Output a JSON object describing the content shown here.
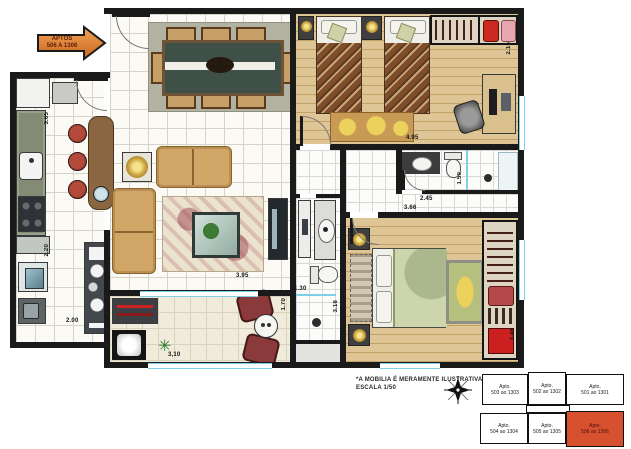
{
  "arrow": {
    "line1": "APTOS",
    "line2": "506 A 1306"
  },
  "note": {
    "line1": "*A MOBILIA É MERAMENTE ILUSTRATIVA, NÃO FAZ PARTE DO MÓVEL.",
    "line2": "ESCALA 1/50"
  },
  "dims": {
    "kitchen_h": "3.65",
    "service_h": "2.20",
    "service_w": "2.00",
    "living_w": "3.95",
    "balcony_w": "3,10",
    "balcony_h": "1.70",
    "bedroom1_w": "4.95",
    "bedroom1_h": "2.15",
    "bath_right_h": "1.50",
    "hall_w": "2.45",
    "master_w": "3.66",
    "shower_w": "1.30",
    "bath2_h": "3.18",
    "master_h": "3.46"
  },
  "keyplan": {
    "circulation": "Circulação",
    "units": [
      {
        "name": "Apto.",
        "range": "503 ao 1303",
        "highlighted": false
      },
      {
        "name": "Apto.",
        "range": "502 ao 1302",
        "highlighted": false
      },
      {
        "name": "Apto.",
        "range": "501 ao 1301",
        "highlighted": false
      },
      {
        "name": "Apto.",
        "range": "504 ao 1304",
        "highlighted": false
      },
      {
        "name": "Apto.",
        "range": "505 ao 1305",
        "highlighted": false
      },
      {
        "name": "Apto.",
        "range": "506 ao 1306",
        "highlighted": true
      }
    ]
  },
  "colors": {
    "highlight": "#d8512e",
    "arrow": "#e58638",
    "wall": "#1a1a1a"
  }
}
